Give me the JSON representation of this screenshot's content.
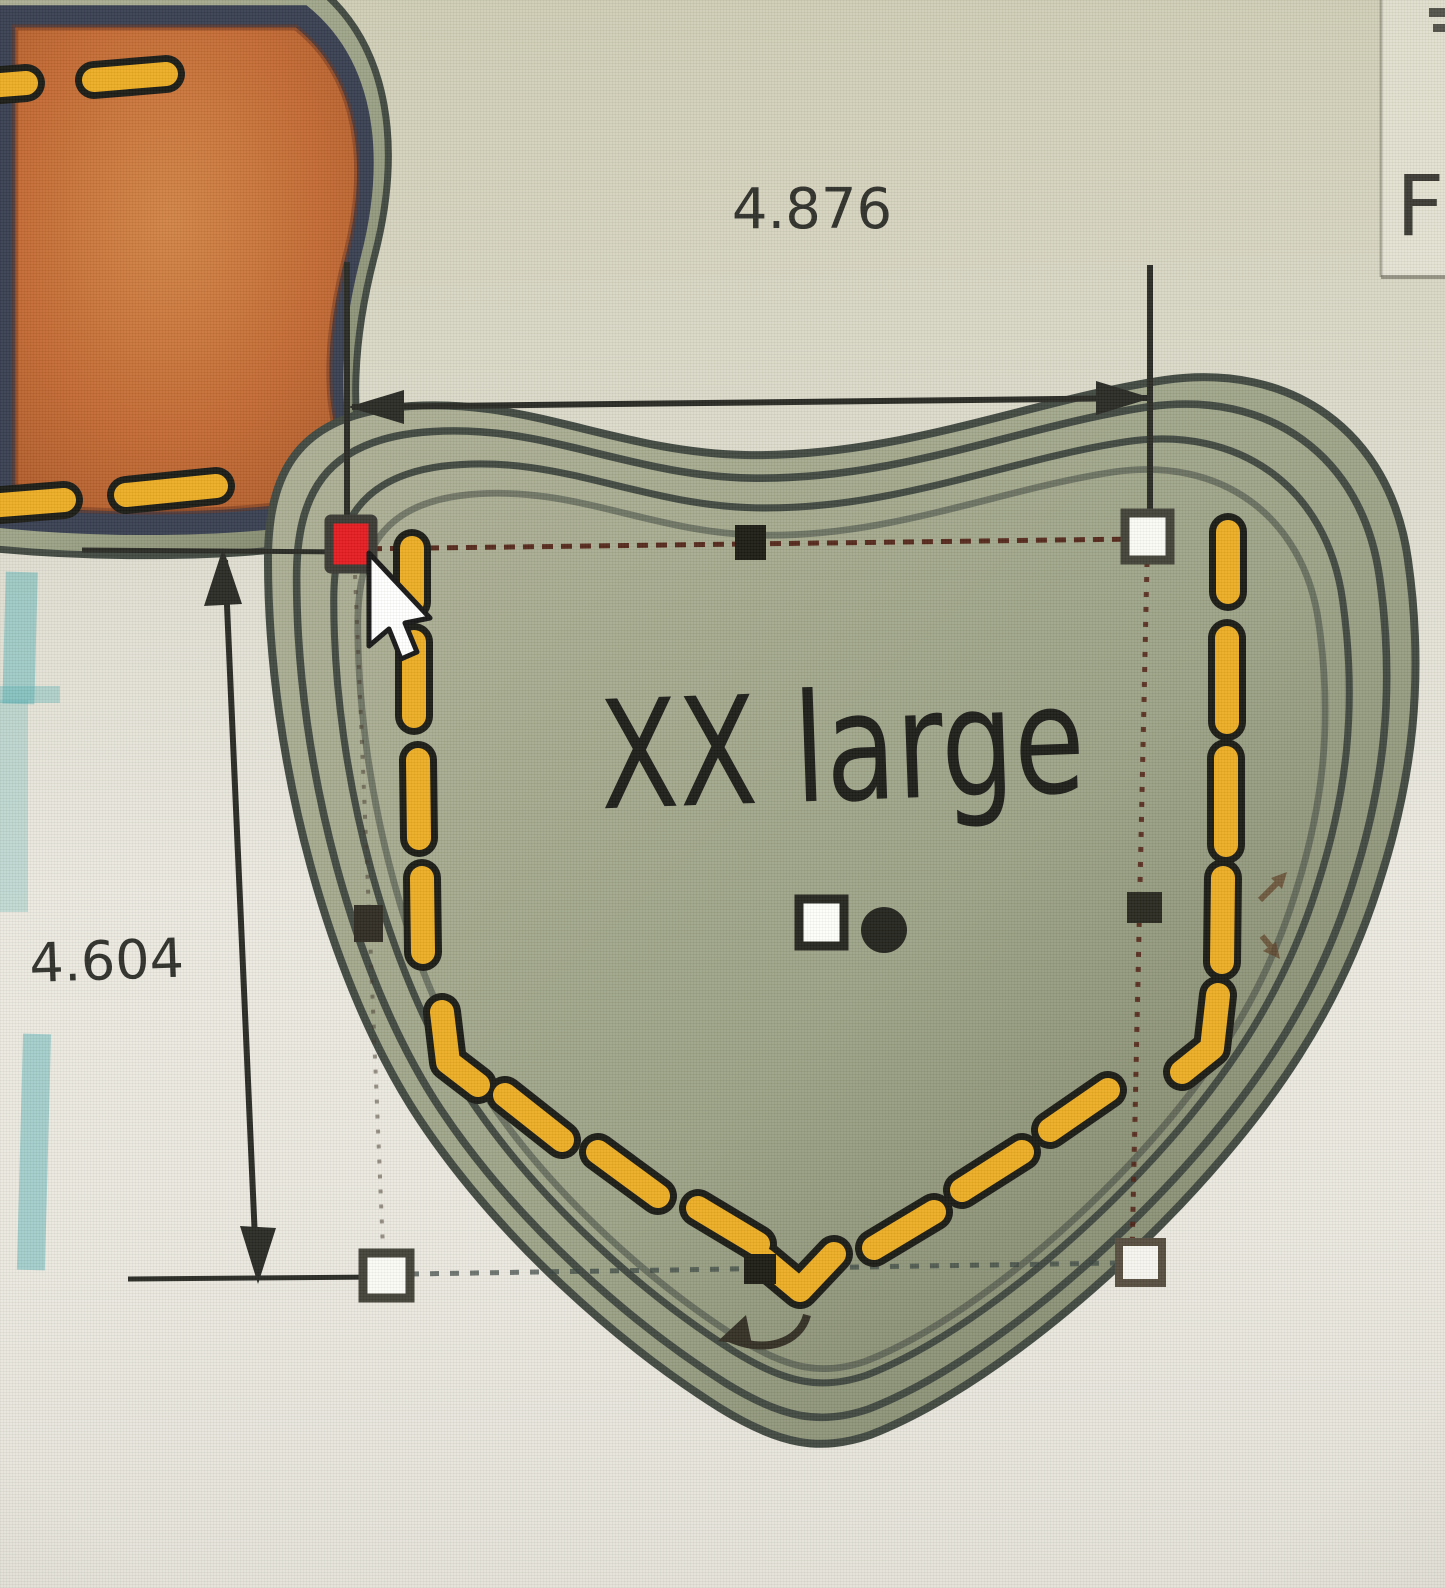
{
  "workspace": {
    "width_dimension": "4.876",
    "height_dimension": "4.604",
    "design_label": "XX large",
    "partial_side_text": "F"
  },
  "colors": {
    "background": "#e8e6dd",
    "background-tint": "#cfcdb6",
    "pocket-band": "#9aa083",
    "pocket-band-light": "#c5c6ac",
    "pocket-outline": "#3c443c",
    "pocket-navy": "#2c3480",
    "pocket-orange": "#c2662e",
    "stitch-yellow": "#ecab1e",
    "stitch-outline": "#151510",
    "handle-red": "#e4161a",
    "handle-white": "#fbfbf6",
    "handle-black": "#16160f",
    "handle-border": "#3e3d34",
    "marquee": "#4a180c",
    "dimension-line": "#24241f",
    "grid-teal": "#58b0b4",
    "text-dark": "#2b2b26"
  }
}
